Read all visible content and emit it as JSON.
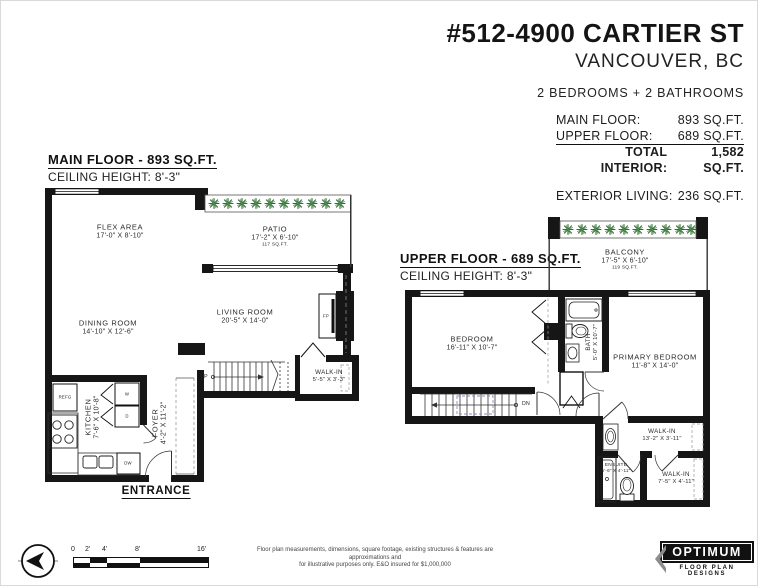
{
  "header": {
    "address": "#512-4900 CARTIER ST",
    "city": "VANCOUVER, BC",
    "beds_baths": "2 BEDROOMS + 2 BATHROOMS",
    "areas": [
      {
        "label": "MAIN FLOOR:",
        "value": "893 SQ.FT."
      },
      {
        "label": "UPPER FLOOR:",
        "value": "689 SQ.FT."
      },
      {
        "label": "TOTAL INTERIOR:",
        "value": "1,582 SQ.FT."
      }
    ],
    "exterior": {
      "label": "EXTERIOR LIVING:",
      "value": "236 SQ.FT."
    }
  },
  "main_floor": {
    "title": "MAIN FLOOR - 893 SQ.FT.",
    "ceiling": "CEILING HEIGHT: 8'-3\"",
    "entrance_label": "ENTRANCE",
    "rooms": [
      {
        "name": "FLEX AREA",
        "dims": "17'-0\" X 8'-10\""
      },
      {
        "name": "PATIO",
        "dims": "17'-2\" X 6'-10\"",
        "area": "117 SQ.FT."
      },
      {
        "name": "DINING ROOM",
        "dims": "14'-10\" X 12'-6\""
      },
      {
        "name": "LIVING ROOM",
        "dims": "20'-5\" X 14'-0\""
      },
      {
        "name": "KITCHEN",
        "dims": "7'-6\" X 10'-8\""
      },
      {
        "name": "FOYER",
        "dims": "4'-2\" X 11'-2\""
      },
      {
        "name": "WALK-IN",
        "dims": "5'-5\" X 3'-3\""
      }
    ],
    "fixtures": {
      "fridge": "REFG",
      "washer": "W",
      "dryer": "D",
      "dishwasher": "DW",
      "fireplace": "FP",
      "stairs": "UP"
    }
  },
  "upper_floor": {
    "title": "UPPER FLOOR - 689 SQ.FT.",
    "ceiling": "CEILING HEIGHT: 8'-3\"",
    "rooms": [
      {
        "name": "BALCONY",
        "dims": "17'-5\" X 6'-10\"",
        "area": "119 SQ.FT."
      },
      {
        "name": "BEDROOM",
        "dims": "16'-11\" X 10'-7\""
      },
      {
        "name": "BATH",
        "dims": "5'-0\" X 10'-7\""
      },
      {
        "name": "PRIMARY BEDROOM",
        "dims": "11'-8\" X 14'-0\""
      },
      {
        "name": "WALK-IN",
        "dims": "13'-2\" X 3'-11\""
      },
      {
        "name": "ENSUITE",
        "dims": "5'-6\" X 4'-11\""
      },
      {
        "name": "WALK-IN",
        "dims": "7'-5\" X 4'-11\""
      }
    ],
    "fixtures": {
      "stairs": "DN"
    }
  },
  "footer": {
    "scale_labels": [
      "0",
      "2'",
      "4'",
      "8'",
      "16'"
    ],
    "disclaimer_line1": "Floor plan measurements, dimensions, square footage, existing structures & features are approximations and",
    "disclaimer_line2": "for illustrative purposes only. E&O insured for $1,000,000",
    "logo_name": "OPTIMUM",
    "logo_tagline": "FLOOR PLAN DESIGNS"
  },
  "colors": {
    "wall": "#161616",
    "plant_green": "#2e6b2e",
    "accent_text": "#111111"
  }
}
